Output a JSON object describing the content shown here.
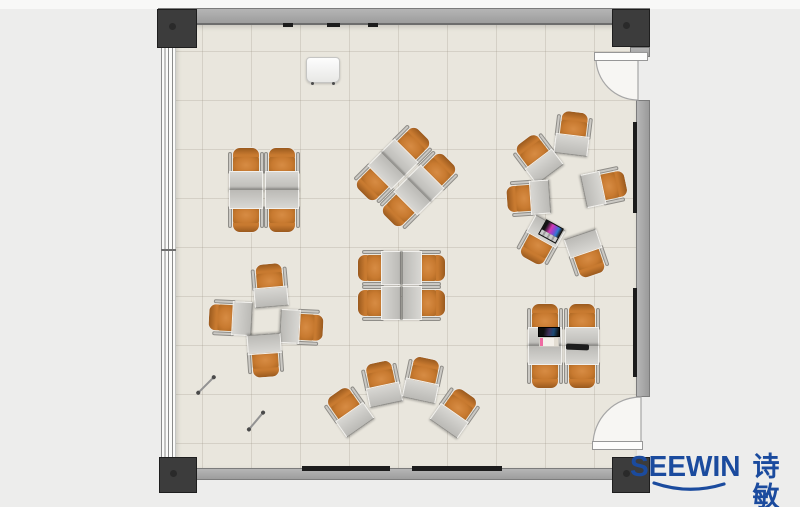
{
  "logo": {
    "brand_en": "SEEWIN",
    "brand_cn": "诗敏",
    "color": "#1b4b9e"
  },
  "colors": {
    "accent_blue": "#1b4b9e",
    "chair_orange": "#c87a30",
    "desk_gray": "#c5c4c0",
    "floor_beige": "#e9e6dd",
    "wall_gray": "#a9a9a9",
    "column_dark": "#3c3c3c"
  },
  "floorplan": {
    "description": "Top-view classroom floor plan with 30 single desk-and-chair units in 7 clusters, windows on left wall, two doors on right wall",
    "clusters": [
      {
        "name": "grid-2x2-top-left"
      },
      {
        "name": "diamond-2x2-top-center"
      },
      {
        "name": "circle-of-6-top-right"
      },
      {
        "name": "plus-4-mid-left"
      },
      {
        "name": "grid-2x2-center"
      },
      {
        "name": "fan-4-bottom-center"
      },
      {
        "name": "grid-2x2-bottom-right"
      }
    ],
    "units": [
      {
        "cluster": "grid-2x2-top-left",
        "x": 246,
        "y": 169,
        "rot": 0
      },
      {
        "cluster": "grid-2x2-top-left",
        "x": 282,
        "y": 169,
        "rot": 0
      },
      {
        "cluster": "grid-2x2-top-left",
        "x": 246,
        "y": 211,
        "rot": 180
      },
      {
        "cluster": "grid-2x2-top-left",
        "x": 282,
        "y": 211,
        "rot": 180
      },
      {
        "cluster": "diamond-2x2-top-center",
        "x": 408,
        "y": 149,
        "rot": 45
      },
      {
        "cluster": "diamond-2x2-top-center",
        "x": 434,
        "y": 175,
        "rot": 45
      },
      {
        "cluster": "diamond-2x2-top-center",
        "x": 378,
        "y": 179,
        "rot": 225
      },
      {
        "cluster": "diamond-2x2-top-center",
        "x": 404,
        "y": 205,
        "rot": 225
      },
      {
        "cluster": "circle-of-6-top-right",
        "x": 573,
        "y": 133,
        "rot": 7
      },
      {
        "cluster": "circle-of-6-top-right",
        "x": 537,
        "y": 157,
        "rot": -37
      },
      {
        "cluster": "circle-of-6-top-right",
        "x": 528,
        "y": 198,
        "rot": -94
      },
      {
        "cluster": "circle-of-6-top-right",
        "x": 540,
        "y": 242,
        "rot": -151
      },
      {
        "cluster": "circle-of-6-top-right",
        "x": 587,
        "y": 255,
        "rot": 161
      },
      {
        "cluster": "circle-of-6-top-right",
        "x": 605,
        "y": 187,
        "rot": 78
      },
      {
        "cluster": "plus-4-mid-left",
        "x": 270,
        "y": 285,
        "rot": -5
      },
      {
        "cluster": "plus-4-mid-left",
        "x": 230,
        "y": 318,
        "rot": -87
      },
      {
        "cluster": "plus-4-mid-left",
        "x": 302,
        "y": 327,
        "rot": 93
      },
      {
        "cluster": "plus-4-mid-left",
        "x": 265,
        "y": 356,
        "rot": 176
      },
      {
        "cluster": "grid-2x2-center",
        "x": 379,
        "y": 268,
        "rot": -90
      },
      {
        "cluster": "grid-2x2-center",
        "x": 424,
        "y": 268,
        "rot": 90
      },
      {
        "cluster": "grid-2x2-center",
        "x": 379,
        "y": 303,
        "rot": -90
      },
      {
        "cluster": "grid-2x2-center",
        "x": 424,
        "y": 303,
        "rot": 90
      },
      {
        "cluster": "fan-4-bottom-center",
        "x": 348,
        "y": 410,
        "rot": -35
      },
      {
        "cluster": "fan-4-bottom-center",
        "x": 382,
        "y": 383,
        "rot": -12
      },
      {
        "cluster": "fan-4-bottom-center",
        "x": 423,
        "y": 379,
        "rot": 12
      },
      {
        "cluster": "fan-4-bottom-center",
        "x": 456,
        "y": 411,
        "rot": 35
      },
      {
        "cluster": "grid-2x2-bottom-right",
        "x": 545,
        "y": 325,
        "rot": 0
      },
      {
        "cluster": "grid-2x2-bottom-right",
        "x": 582,
        "y": 325,
        "rot": 0
      },
      {
        "cluster": "grid-2x2-bottom-right",
        "x": 545,
        "y": 367,
        "rot": 180
      },
      {
        "cluster": "grid-2x2-bottom-right",
        "x": 582,
        "y": 367,
        "rot": 180
      }
    ],
    "objects": [
      {
        "type": "easel",
        "x": 306,
        "y": 57,
        "rot": 0
      },
      {
        "type": "stick",
        "x": 195,
        "y": 384,
        "rot": -45
      },
      {
        "type": "stick",
        "x": 245,
        "y": 420,
        "rot": -50
      },
      {
        "type": "laptop_open",
        "x": 538,
        "y": 327,
        "rot": 0
      },
      {
        "type": "laptop_color",
        "x": 541,
        "y": 223,
        "rot": 29
      },
      {
        "type": "tablet",
        "x": 566,
        "y": 344,
        "rot": 2
      }
    ]
  }
}
